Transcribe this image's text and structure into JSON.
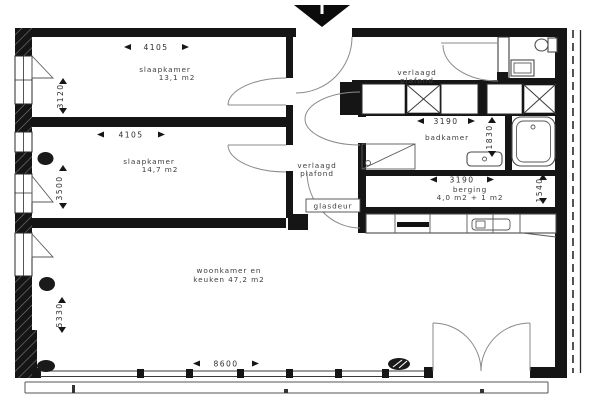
{
  "plan_type": "apartment-floorplan",
  "rooms": {
    "bedroom1": {
      "name": "slaapkamer",
      "area": "13,1 m2"
    },
    "bedroom2": {
      "name": "slaapkamer",
      "area": "14,7 m2"
    },
    "living": {
      "line1": "woonkamer en",
      "line2": "keuken 47,2 m2"
    },
    "bathroom": {
      "name": "badkamer"
    },
    "storage": {
      "name": "berging",
      "area": "4,0 m2 + 1 m2"
    }
  },
  "dimensions": {
    "bedroom1_width": "4105",
    "bedroom1_depth": "3120",
    "bedroom2_width": "4105",
    "bedroom2_depth": "3500",
    "living_width": "8600",
    "living_depth": "5330",
    "bathroom_width": "3190",
    "bathroom_depth": "1830",
    "storage_width": "3190",
    "storage_depth": "1540"
  },
  "annotations": {
    "lowered_ceiling_service": {
      "line1": "verlaagd",
      "line2": "plafond"
    },
    "lowered_ceiling_hall": {
      "line1": "verlaagd",
      "line2": "plafond"
    },
    "glass_door": "glasdeur"
  },
  "colors": {
    "wall": "#151515",
    "background": "#ffffff",
    "door_arc": "#8a8a8a",
    "text": "#3d3d3d"
  }
}
